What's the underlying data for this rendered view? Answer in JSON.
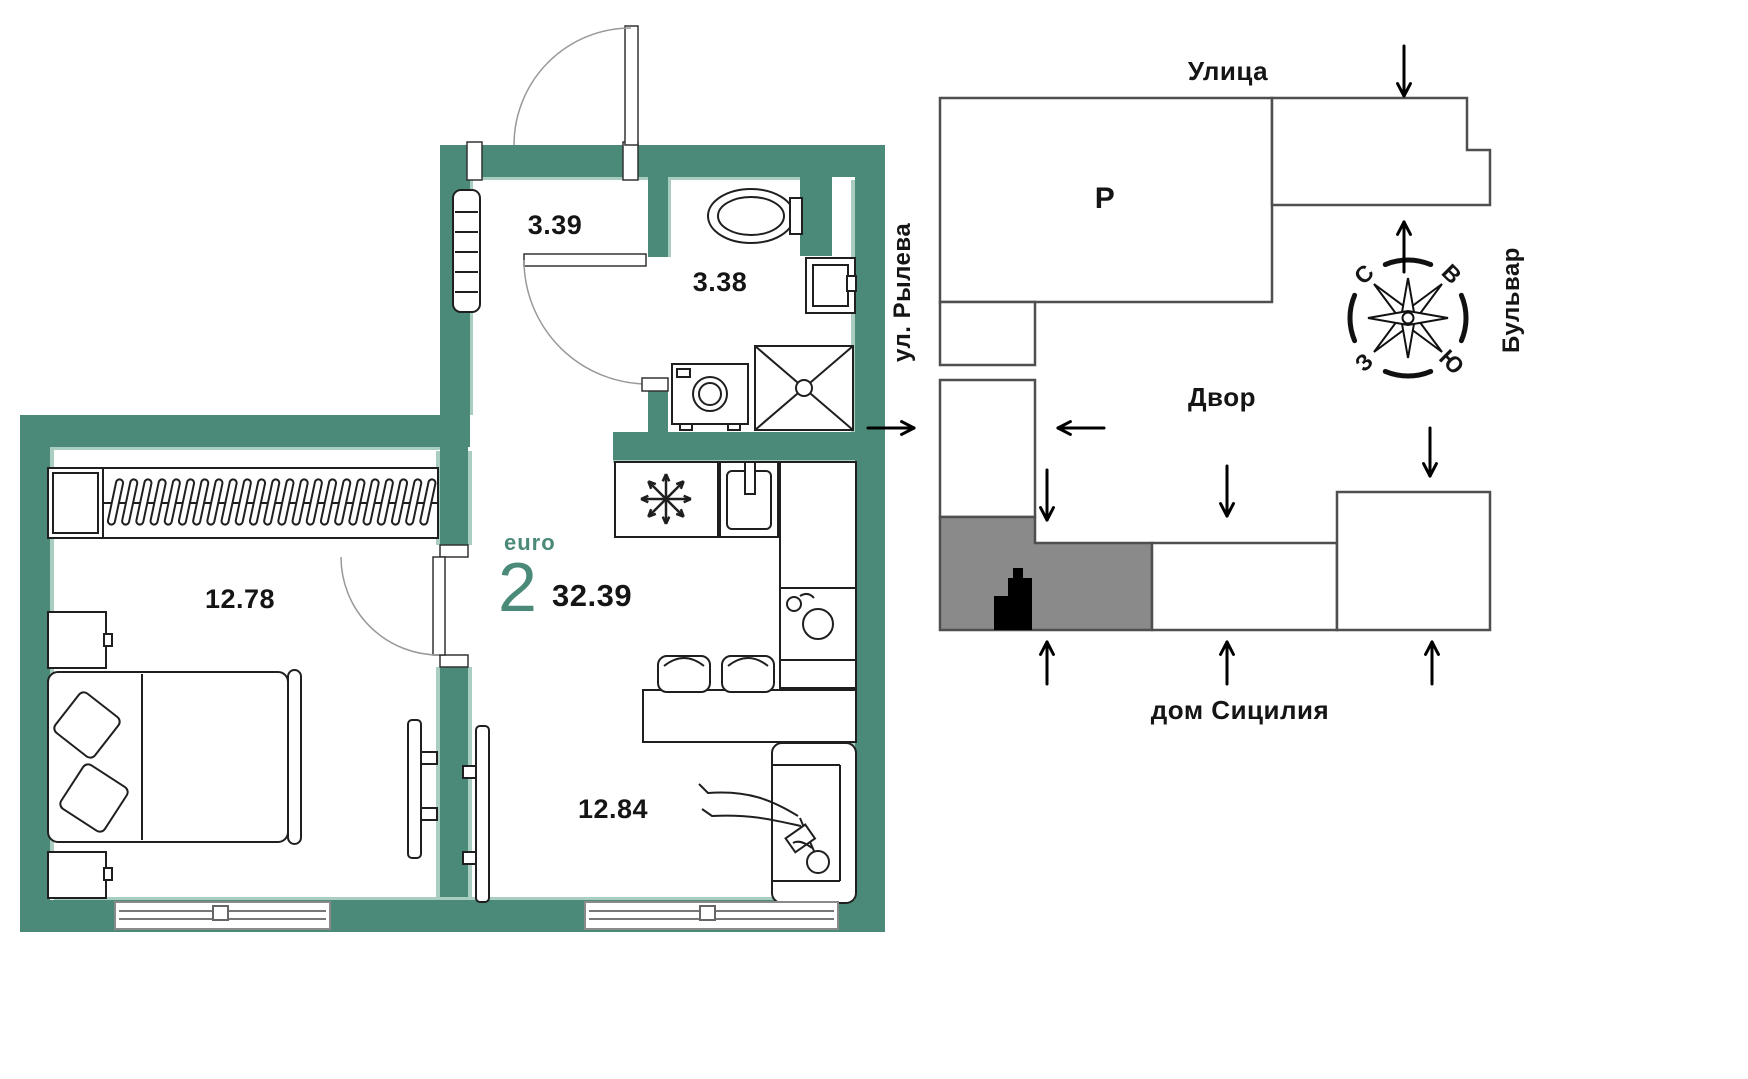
{
  "plan": {
    "type_label": "euro",
    "type_rooms": "2",
    "total_area": "32.39",
    "areas": {
      "hallway": "3.39",
      "bathroom": "3.38",
      "bedroom": "12.78",
      "living_kitchen": "12.84"
    }
  },
  "site": {
    "street_top": "Улица",
    "street_left": "ул. Рылева",
    "boulevard_right": "Бульвар",
    "courtyard": "Двор",
    "house_name": "дом Сицилия",
    "parking": "Р",
    "compass": {
      "north": "С",
      "east": "В",
      "south": "Ю",
      "west": "З"
    }
  },
  "colors": {
    "wall": "#4B8A79",
    "wall_inner_face": "#A9CDC1",
    "ink": "#1F1F1F",
    "map_outline": "#4F4F4F",
    "current_block_gray": "#8A8A8A",
    "apartment_marker": "#000000"
  }
}
